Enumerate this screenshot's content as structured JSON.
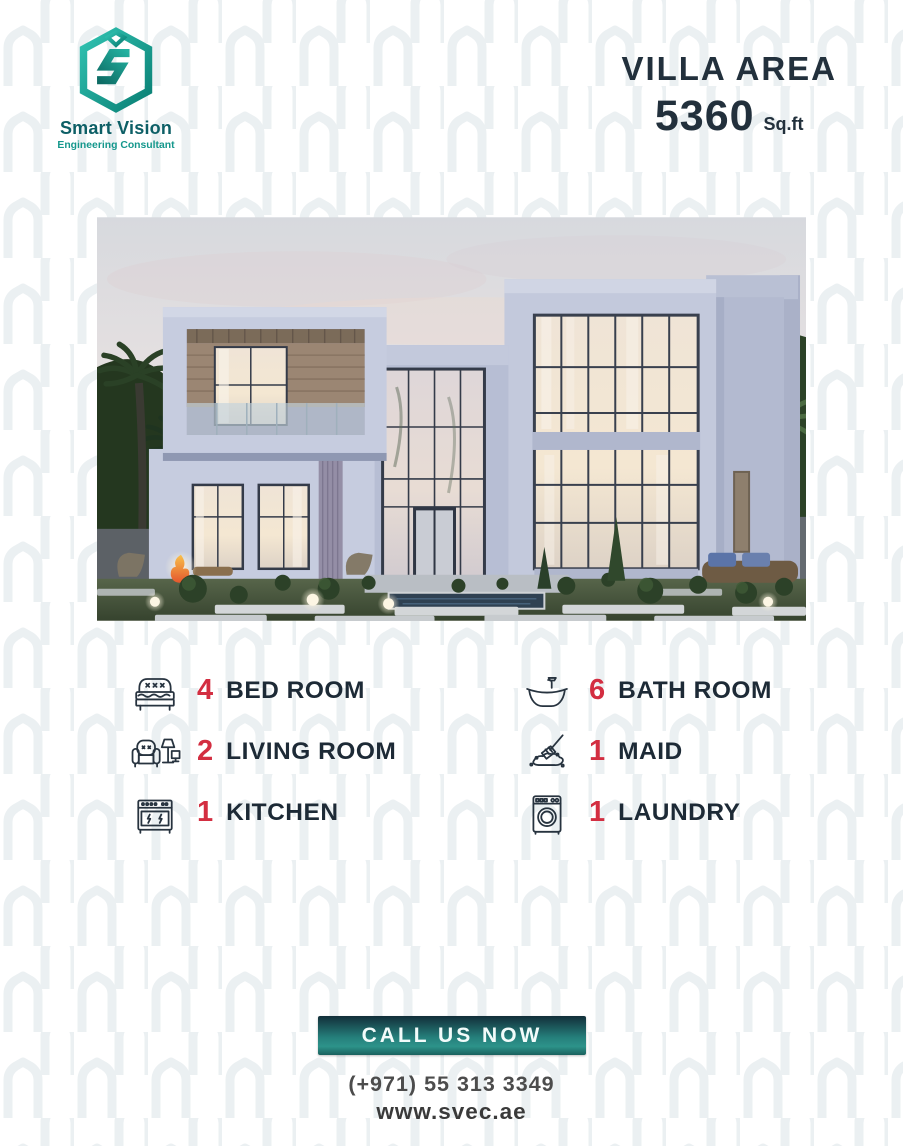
{
  "brand": {
    "name": "Smart Vision",
    "tagline": "Engineering Consultant",
    "logo_icon": "hexagon-s-logo",
    "name_color": "#0d5f66",
    "tagline_color": "#14978c",
    "teal_light": "#31c3b2",
    "teal_dark": "#0a7f74"
  },
  "header": {
    "area_title": "VILLA AREA",
    "area_value": "5360",
    "area_unit": "Sq.ft"
  },
  "photo": {
    "alt": "Modern two-storey villa exterior at dusk with palm trees, large glass facades, garden bushes, glowing sphere lights, fire pit and reflecting pool"
  },
  "features": {
    "accent_color": "#d32e41",
    "text_color": "#1d2a36",
    "items": [
      {
        "count": "4",
        "label": "BED ROOM",
        "icon": "bed-icon"
      },
      {
        "count": "6",
        "label": "BATH ROOM",
        "icon": "bathtub-icon"
      },
      {
        "count": "2",
        "label": "LIVING ROOM",
        "icon": "armchair-lamp-tv-icon"
      },
      {
        "count": "1",
        "label": "MAID",
        "icon": "cleaning-brush-icon"
      },
      {
        "count": "1",
        "label": "KITCHEN",
        "icon": "stove-icon"
      },
      {
        "count": "1",
        "label": "LAUNDRY",
        "icon": "washing-machine-icon"
      }
    ]
  },
  "footer": {
    "cta_label": "CALL US NOW",
    "phone": "(+971) 55 313 3349",
    "website": "www.svec.ae",
    "button_gradient_top": "#122e39",
    "button_gradient_bottom": "#2d938a"
  }
}
